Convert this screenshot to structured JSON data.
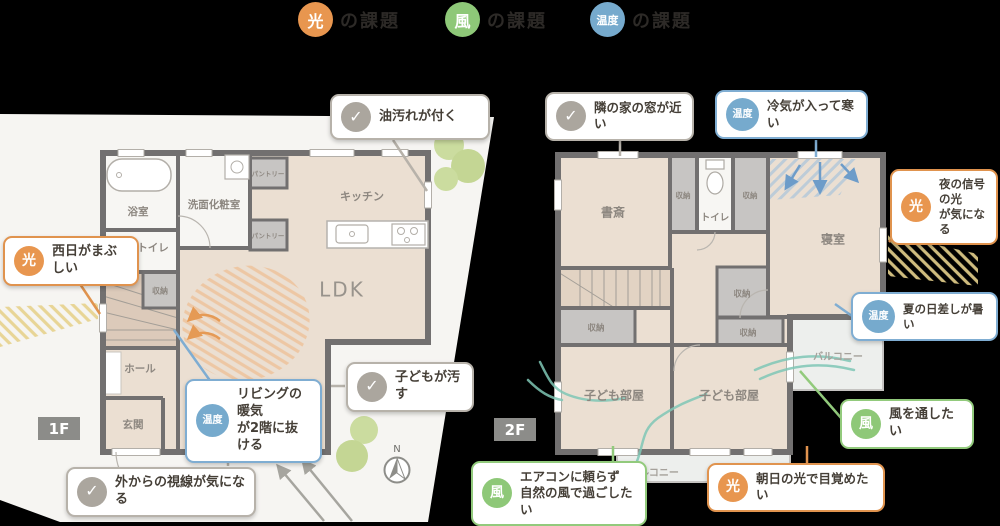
{
  "legend": {
    "items": [
      {
        "badge": "光",
        "label": "の課題"
      },
      {
        "badge": "風",
        "label": "の課題"
      },
      {
        "badge": "温度",
        "label": "の課題"
      }
    ]
  },
  "icons": {
    "check": "✓",
    "north": "N"
  },
  "colors": {
    "light": "#E8964F",
    "wind": "#8EC878",
    "temp": "#76AACD",
    "check": "#ABA69E"
  },
  "floor1": {
    "tag": "1F",
    "rooms": {
      "bath": "浴室",
      "washroom": "洗面化粧室",
      "pantry1": "パントリー",
      "pantry2": "パントリー",
      "kitchen": "キッチン",
      "ldk": "LDK",
      "toilet": "トイレ",
      "storage": "収納",
      "hall": "ホール",
      "entrance": "玄関"
    },
    "callouts": {
      "oil": {
        "text": "油汚れが付く"
      },
      "west_sun": {
        "badge": "光",
        "text": "西日がまぶしい"
      },
      "warm_air": {
        "badge": "温度",
        "line1": "リビングの暖気",
        "line2": "が2階に抜ける"
      },
      "kids_mess": {
        "text": "子どもが汚す"
      },
      "gaze": {
        "text": "外からの視線が気になる"
      }
    }
  },
  "floor2": {
    "tag": "2F",
    "rooms": {
      "study": "書斎",
      "storage_a": "収納",
      "toilet": "トイレ",
      "storage_b": "収納",
      "bedroom": "寝室",
      "storage_c": "収納",
      "storage_d": "収納",
      "storage_e": "収納",
      "kids_left": "子ども部屋",
      "kids_right": "子ども部屋",
      "balcony_right": "バルコニー",
      "balcony_bottom": "バルコニー"
    },
    "callouts": {
      "neighbor_window": {
        "text": "隣の家の窓が近い"
      },
      "cold_air": {
        "badge": "温度",
        "text": "冷気が入って寒い"
      },
      "signal_light": {
        "badge": "光",
        "line1": "夜の信号の光",
        "line2": "が気になる"
      },
      "summer_sun": {
        "badge": "温度",
        "text": "夏の日差しが暑い"
      },
      "wind_through": {
        "badge": "風",
        "text": "風を通したい"
      },
      "aircon": {
        "badge": "風",
        "line1": "エアコンに頼らず",
        "line2": "自然の風で過ごしたい"
      },
      "morning_sun": {
        "badge": "光",
        "text": "朝日の光で目覚めたい"
      }
    }
  }
}
